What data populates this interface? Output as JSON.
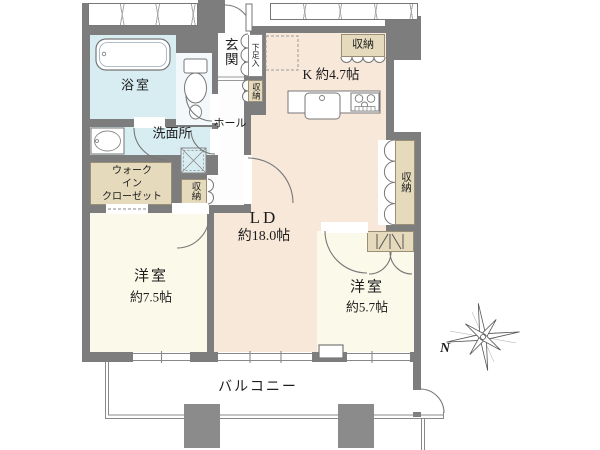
{
  "plan": {
    "rooms": {
      "genkan": {
        "label": "玄関"
      },
      "shoe_cabinet": {
        "label": "下足入"
      },
      "genkan_storage": {
        "label": "収納"
      },
      "bathroom": {
        "label": "浴室"
      },
      "washroom": {
        "label": "洗面所"
      },
      "hall": {
        "label": "ホール"
      },
      "wic": {
        "line1": "ウォーク",
        "line2": "イン",
        "line3": "クローゼット"
      },
      "hall_storage": {
        "label": "収納"
      },
      "kitchen": {
        "label": "K 約4.7帖",
        "storage": "収納"
      },
      "living_dining": {
        "label": "LD",
        "size": "約18.0帖"
      },
      "side_storage": {
        "label": "収納"
      },
      "bedroom_west": {
        "label": "洋室",
        "size": "約7.5帖"
      },
      "bedroom_east": {
        "label": "洋室",
        "size": "約5.7帖"
      },
      "balcony": {
        "label": "バルコニー"
      }
    },
    "compass": {
      "north": "N"
    }
  },
  "colors": {
    "wall": "#7d7d7d",
    "water": "#d8edf2",
    "room": "#f8e8da",
    "bedroom": "#fbfaea",
    "storage": "#e6dabd",
    "line": "#777777"
  }
}
